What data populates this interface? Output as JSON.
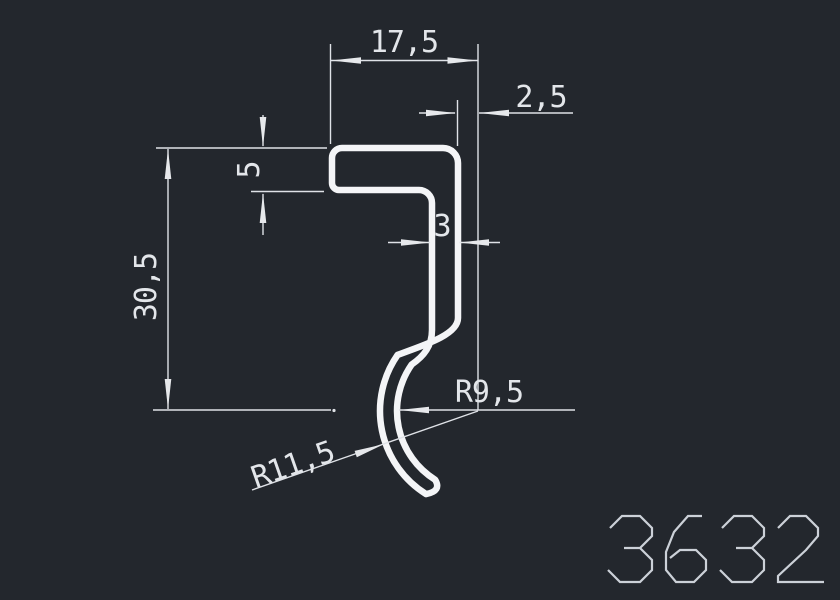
{
  "drawing": {
    "title_number": "3632",
    "background_color": "#23272d",
    "profile_stroke_color": "#f4f5f7",
    "dimension_color": "#dfe2e7",
    "dimensions": {
      "width_top": "17,5",
      "offset_top_right": "2,5",
      "flange_thickness": "5",
      "wall_thickness": "3",
      "height_left": "30,5",
      "radius_inner": "R9,5",
      "radius_outer": "R11,5"
    }
  }
}
